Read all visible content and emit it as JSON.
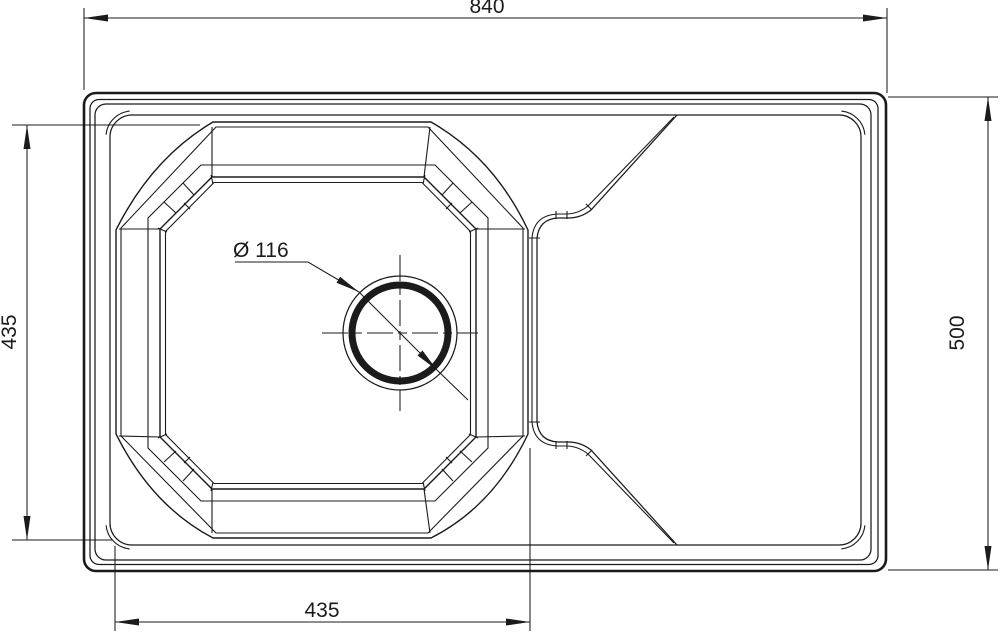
{
  "drawing": {
    "title": "Kitchen sink top view technical drawing",
    "background": "#ffffff",
    "line_color": "#1b1b1b",
    "dimensions": {
      "overall_width": {
        "label": "840",
        "position": "top"
      },
      "overall_depth": {
        "label": "500",
        "position": "right"
      },
      "bowl_depth": {
        "label": "435",
        "position": "left"
      },
      "bowl_width": {
        "label": "435",
        "position": "bottom"
      },
      "drain_diameter": {
        "label": "Ø 116",
        "position": "center"
      }
    }
  }
}
